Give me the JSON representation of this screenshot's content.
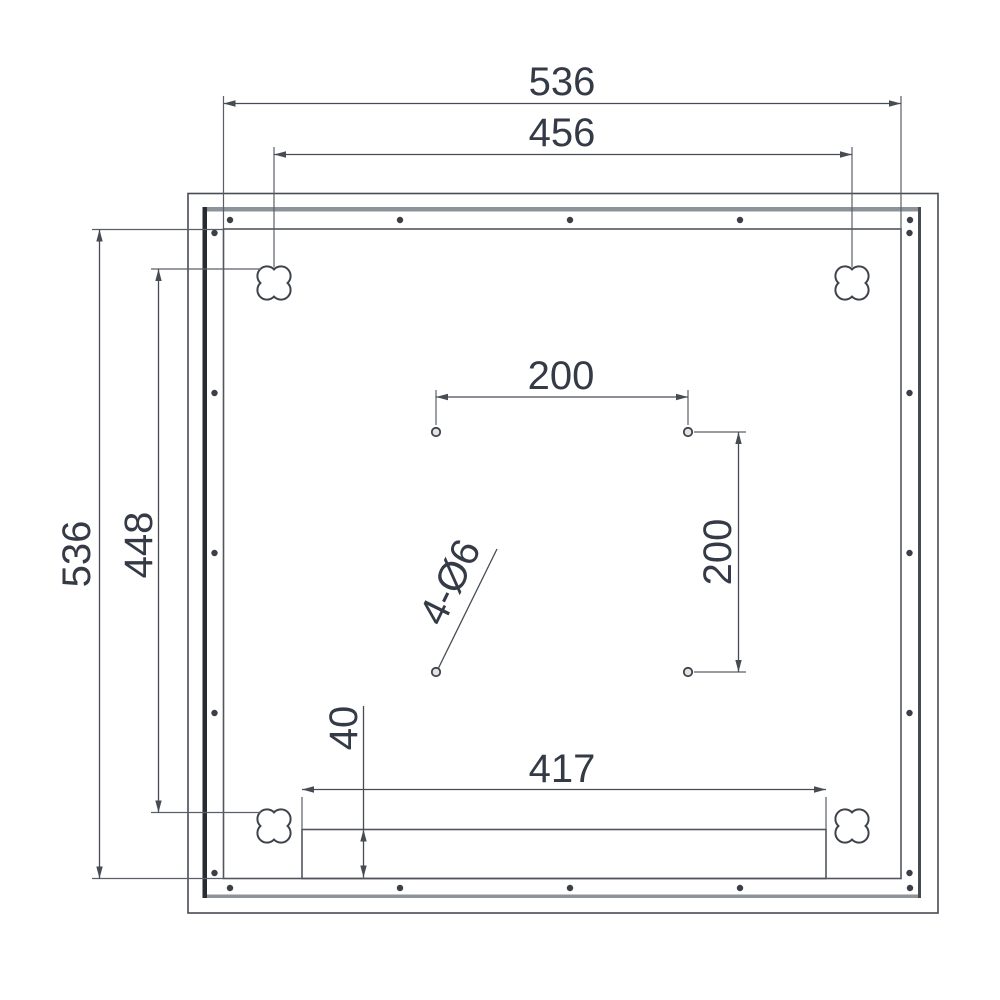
{
  "drawing": {
    "type": "technical-dimension-drawing",
    "labels": {
      "overall_width": "536",
      "keyhole_span_width": "456",
      "overall_height": "536",
      "keyhole_span_height": "448",
      "center_hole_spacing_h": "200",
      "center_hole_spacing_v": "200",
      "slot_width": "417",
      "slot_height": "40",
      "hole_callout": "4-Ø6"
    },
    "colors": {
      "line": "#474c54",
      "text": "#343a46",
      "frame_dark_edge": "#272c33",
      "frame_gray_edge": "#8e939a"
    }
  }
}
